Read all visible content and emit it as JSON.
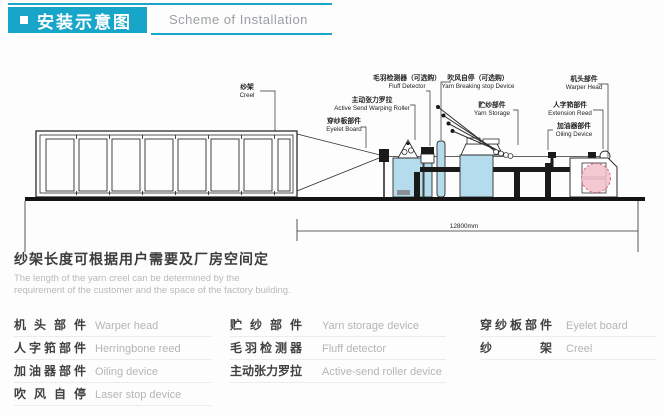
{
  "header": {
    "title_zh": "安装示意图",
    "title_en": "Scheme of Installation",
    "accent_color": "#17a5c9"
  },
  "diagram": {
    "dimension_label": "12800mm",
    "machine_fill_color": "#b5dcec",
    "beam_color": "#f3bfca",
    "labels": {
      "creel": {
        "zh": "纱架",
        "en": "Creel"
      },
      "eyelet_board": {
        "zh": "穿纱板部件",
        "en": "Eyelet Board"
      },
      "active_roller": {
        "zh": "主动张力罗拉",
        "en": "Active Send Warping Roller"
      },
      "fluff_detector": {
        "zh": "毛羽检测器（可选购）",
        "en": "Fluff Detector"
      },
      "yarn_breaking": {
        "zh": "吹风自停（可选购）",
        "en": "Yarn Breaking stop Device"
      },
      "yarn_storage": {
        "zh": "贮纱部件",
        "en": "Yarn Storage"
      },
      "warper_head": {
        "zh": "机头部件",
        "en": "Warper Head"
      },
      "extension_reed": {
        "zh": "人字筘部件",
        "en": "Extension Reed"
      },
      "oiling_device": {
        "zh": "加油器部件",
        "en": "Oiling Device"
      }
    }
  },
  "note": {
    "zh": "纱架长度可根据用户需要及厂房空间定",
    "en_line1": "The length of the yarn creel can be determined by the",
    "en_line2": "requirement of the customer and the space of the factory building."
  },
  "legend": {
    "columns": [
      {
        "items": [
          {
            "zh": "机头部件",
            "en": "Warper head"
          },
          {
            "zh": "人字筘部件",
            "en": "Herringbone reed"
          },
          {
            "zh": "加油器部件",
            "en": "Oiling device"
          },
          {
            "zh": "吹风自停",
            "en": "Laser stop device"
          }
        ]
      },
      {
        "items": [
          {
            "zh": "贮纱部件",
            "en": "Yarn storage device"
          },
          {
            "zh": "毛羽检测器",
            "en": "Fluff detector"
          },
          {
            "zh": "主动张力罗拉",
            "en": "Active-send roller device"
          }
        ]
      },
      {
        "items": [
          {
            "zh": "穿纱板部件",
            "en": "Eyelet board"
          },
          {
            "zh": "纱架",
            "en": "Creel"
          }
        ]
      }
    ]
  }
}
